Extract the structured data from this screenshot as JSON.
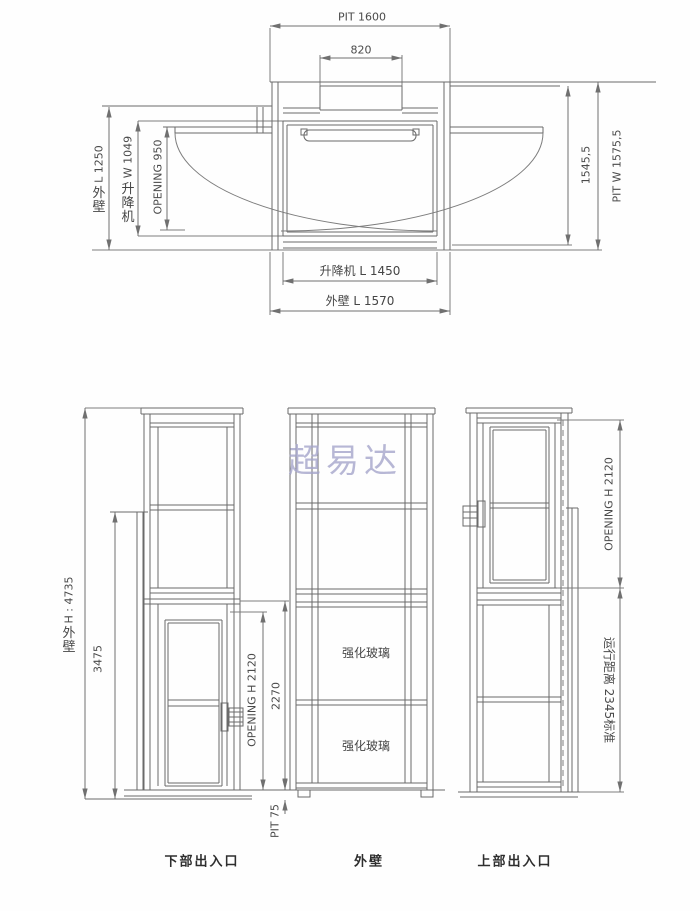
{
  "watermark": "超易达",
  "top_view": {
    "dim_pit_length": "PIT 1600",
    "dim_box_width": "820",
    "dim_outer_wall_left_num": "L 1250",
    "dim_outer_wall_left_cjk": "外壁",
    "dim_lift_width_num": "W 1049",
    "dim_lift_width_cjk": "升降机",
    "dim_opening_width": "OPENING 950",
    "dim_inner_width": "1545,5",
    "dim_pit_width": "PIT W 1575,5",
    "dim_lift_length": "升降机 L 1450",
    "dim_outer_wall_length": "外壁 L 1570"
  },
  "front_views": {
    "lower_entrance": {
      "dim_outer_height_num": "H : 4735",
      "dim_outer_height_cjk": "外壁",
      "dim_mid_height": "3475",
      "dim_opening_height": "OPENING H 2120",
      "dim_door_height": "2270",
      "dim_pit_depth": "PIT 75",
      "caption": "下部出入口"
    },
    "outer_wall": {
      "glass_label_upper": "强化玻璃",
      "glass_label_lower": "强化玻璃",
      "caption": "外壁"
    },
    "upper_entrance": {
      "dim_opening_height": "OPENING H 2120",
      "dim_travel_distance": "运行距离 2345标准",
      "caption": "上部出入口"
    }
  }
}
